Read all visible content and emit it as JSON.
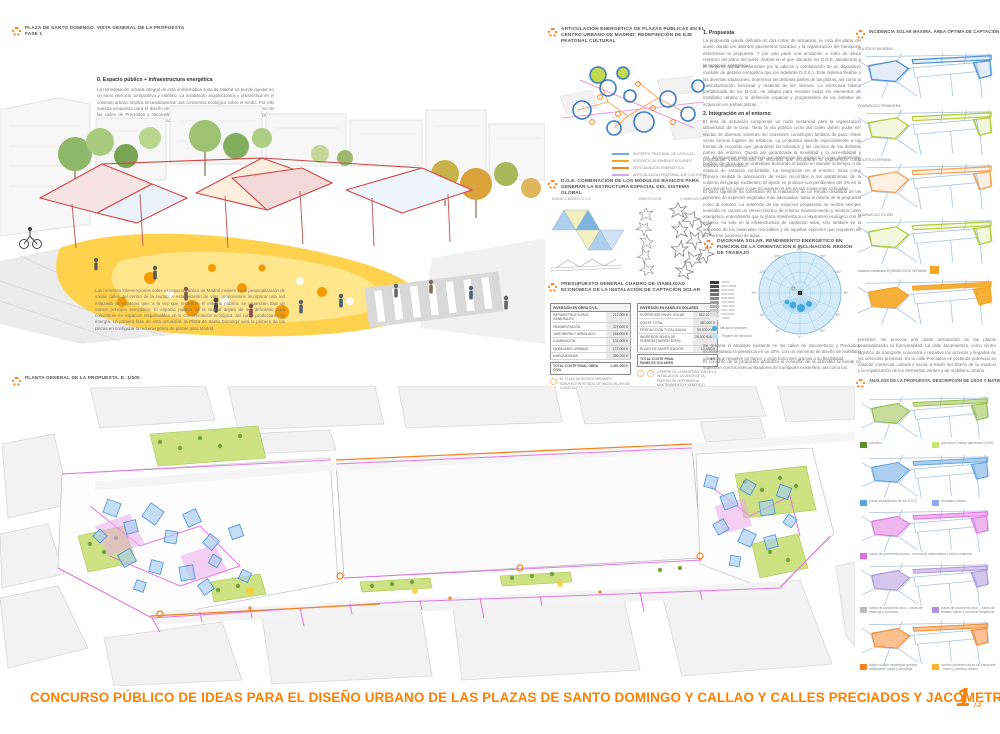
{
  "accent": "#f58220",
  "title_orange": "#ff8000",
  "top_left": {
    "title_line1": "PLAZA DE SANTO DOMINGO. VISTA GENERAL DE LA PROPUESTA",
    "title_line2": "FASE 1",
    "heading": "0. Espacio público + Infraestructura energética",
    "para1": "La remodelación urbana integral de esta emblemática zona de Madrid no puede quedar en un mero ejercicio compositivo y estético. La instalación arquitectónica y urbanística en el contexto urbano implica necesariamente una conciencia ecológica sobre el medio. Por ello nuestra propuesta para el diseño de las Plazas de Santo Domingo y Callao así como de las calles de Preciados y Jacometrezo plantea la definición de un sistema energético articulado de captación de energía solar.",
    "para2": "Las recientes intervenciones sobre el espacio público de Madrid insisten en la peatonalización de varias calles del centro de la ciudad. A esta relación de vías, proponemos incorporar una red enlazada de espacios que, a la vez que resuelven el entorno público, se organizan bajo un mismo principio energético. El espacio público de la ciudad dejará de ser deficitario para convertirse en espacios responsables en la concienciación ecológica, así como productores de energía. La primera fase de esta actuación, la Plaza de Santo Domingo será la primera de las plazas en configurar la red energética de plazas para Madrid."
  },
  "articulacion": {
    "title": "ARTICULACIÓN ENERGÉTICA DE PLAZAS PÚBLICAS EN EL CENTRO URBANO DE MADRID: REDEFINICIÓN DE EJE PEATONAL CULTURAL",
    "legend": [
      {
        "label": "SOPORTE PEATONAL DE LA PLAZA",
        "color": "#7ba7d7"
      },
      {
        "label": "SOPORTE DE PANELES SOLARES",
        "color": "#f6a623"
      },
      {
        "label": "ARTICULACIÓN ENERGÉTICA",
        "color": "#f58220"
      },
      {
        "label": "ARTICULACIÓN PEATONAL-EJE CULTURAL",
        "color": "#cfa6e8"
      }
    ]
  },
  "dge": {
    "title": "D.G.E. COMBINACIÓN DE LOS MÓDULOS BÁSICOS PARA GENERAR LA ESTRUCTURA ESPACIAL DEL SISTEMA GLOBAL",
    "col1": "MÓDULO BÁSICO D.G.E",
    "col2": "ORIENTACIÓN",
    "col3": "COMBINACIÓN"
  },
  "presupuesto": {
    "title": "PRESUPUESTO GENERAL CUADRO DE VIABILIDAD ECONÓMICA DE LA INSTALACIÓN DE CAPTACIÓN SOLAR",
    "obra": {
      "header": "INVERSIÓN EN OBRA CIVIL",
      "rows": [
        [
          "INFRAESTRUCTURAS GENERALES",
          "212.000 €"
        ],
        [
          "PAVIMENTACIÓN",
          "327.000 €"
        ],
        [
          "JARDINERÍA Y ARBOLADO",
          "264.000 €"
        ],
        [
          "ILUMINACIÓN",
          "134.000 €"
        ],
        [
          "MOBILIARIO URBANO",
          "172.000 €"
        ],
        [
          "MARQUESINAS",
          "350.000 €"
        ]
      ],
      "total_label": "TOTAL COSTE FINAL OBRA CIVIL",
      "total_value": "1.497.000 €",
      "note": "EL PLAZO SE REDUCE MEDIANTE SUBVENCIÓN ESTATAL DE HASTA UN 20% DE LA INSTALACIÓN"
    },
    "paneles": {
      "header": "INVERSIÓN EN PANELES SOLARES",
      "rows": [
        [
          "SUPERFICIE PANEL SOLAR",
          "562.10 m2"
        ],
        [
          "COSTE TOTAL",
          "380.000 €"
        ],
        [
          "PRODUCCIÓN TOTAL ANUAL",
          "55.000 Kwh"
        ],
        [
          "INGRESOS VENTA DE ENERGÍA (TARIFA+575%)",
          "26.000 €/AÑO"
        ],
        [
          "PLAZO DE AMORTIZACIÓN",
          "10 AÑOS"
        ]
      ],
      "total_label": "TOTAL COSTE FINAL PANELES SOLARES",
      "total_value": "0 €",
      "note": "A PARTIR DE LA AMORTIZACIÓN DE LA INSTALACIÓN, LA VENTA DE LA ENERGÍA SE DESTINARÁ AL MANTENIMIENTO Y BENEFICIO PÚBLICO"
    }
  },
  "propuesta": {
    "h1": "1. Propuesta",
    "p1": "La propuesta queda definida en dos cotas de actuación: la cota del plano del suelo, donde los distintos pavimentos trazados y la organización del transporte determinan la propuesta. Y por otra parte una actuación a 3,5m de altura respecto del plano del suelo, ámbito en el que ubicarán los D.G.E. atendiendo a la captación energética.",
    "p2": "El conjunto queda conformado por la adición y combinación de un dispositivo modular de gestión energética tipo (en adelante D.G.E.). Este sistema flexible a las diversas situaciones, determina las distintas partes de las plazas, así como la particularización funcional y material de los mismos. La estructura básica prefabricada de los D.G.E. se adapta para resolver todos los elementos de mobiliario urbano y la definición espacial y programática de los ámbitos de actuación en ambas plazas.",
    "h2": "2. Integración en el entorno",
    "p3": "El área de actuación comprende un nodo sustancial para la organización urbanística de la zona. Tanto la vía pública como las calles deben poder ser vividas de diversas maneras. En ocasiones constituyen ámbitos de paso. Otras veces forman lugares de estancia. La propuesta atiende especialmente a las formas de recorrido que garantizan los tránsitos y las uniones de las distintas partes del entorno. Queda así garantizada la movilidad y la accesibilidad y propiciadas varias formas de recorrido que incorporan la experiencia como objetivo arquitectónico.",
    "p4": "Así, distinguimos entre caminos que atraviesan los espacios lo más rápidamente posible, de otros que se entretejen buscando el paseo en atender al tiempo, o de espacio de estancia confortable. La integración en el entorno, toma como primera medida la adecuación de estos recorridos a las plataformas de la cubierta del garaje existentes. El ajuste se produce con pendientes del 4% en la mayoría de los casos y que no superen el 6% en las zonas más inclinadas.",
    "p5": "El paso siguiente ha consistido en la realización de un estudio detallado de las opciones de especies vegetales más adecuadas, tanto al diseño de la propuesta como al entorno. La selección de las especies propuestas se realiza siempre teniendo en cuenta un criterio técnico de mínimo mantenimiento y mínimo coste energético, entendiendo que la plaza manifiesta su compromiso ecológico con el entorno, no sólo en la infraestructura de captación solar, sino también en la selección de los materiales reciclables y de aquellas especies que requieren de un mínimo consumo de agua."
  },
  "solar": {
    "title": "DIAGRAMA SOLAR. RENDIMIENTO ENERGÉTICO EN FUNCIÓN DE LA ORIENTACIÓN E INCLINACIÓN. REGIÓN DE TRABAJO",
    "scale": [
      {
        "label": "100%",
        "color": "#3a3a3a"
      },
      {
        "label": "95%-100%",
        "color": "#4d4d4d"
      },
      {
        "label": "90%-95%",
        "color": "#606060"
      },
      {
        "label": "85%-90%",
        "color": "#737373"
      },
      {
        "label": "80%-85%",
        "color": "#8a8a8a"
      },
      {
        "label": "75%-80%",
        "color": "#9e9e9e"
      },
      {
        "label": "70%-75%",
        "color": "#b3b3b3"
      },
      {
        "label": "65%-70%",
        "color": "#c7c7c7"
      },
      {
        "label": "60%-65%",
        "color": "#dcdcdc"
      },
      {
        "label": "<50%",
        "color": "#efefef"
      }
    ],
    "degrees": [
      "180°",
      "150°",
      "120°",
      "90°",
      "60°",
      "30°",
      "0°",
      "-30°",
      "-60°",
      "-90°",
      "-120°",
      "-150°"
    ],
    "legend_dot": "situación paneles",
    "legend_region": "Región de afección",
    "p1": "Se respeta el arbolado existente en las calles de Jacometrezo y Preciados, incrementando la presencia en un 20%, con un elemento de diseño de mobiliario urbano que resuelve un banco y otras funciones gracias a su flexibilidad.",
    "p2": "El conjunto de la propuesta garantiza la conexión de la actividad funcional en superficie con los intercambiadores de transporte existentes, así como los"
  },
  "incidencia": {
    "title": "INCIDENCIA SOLAR MÁXIMA. ÁREA ÓPTIMA DE CAPTACIÓN",
    "maps": [
      {
        "label": "SOLSTICIO INVIERNO",
        "color": "#4a90d9"
      },
      {
        "label": "EQUINOCCIO PRIMAVERA",
        "color": "#b5cc34"
      },
      {
        "label": "SOLSTICIO VERANO",
        "color": "#f5a04c"
      },
      {
        "label": "EQUINOCCIO OTOÑO",
        "color": "#b5cc34"
      },
      {
        "label": "máxima incidencia EQUINOCCIOS  VERANO",
        "color": "#f5a623"
      }
    ],
    "p": "previstos. Se provoca una doble articulación de las plazas peatonalizando su funcionalidad. La calle Jacometrezo, como centro logístico de transporte concentra y resuelve los accesos y llegadas de los vehículos previstos. En la calle Preciados se pretende potenciar su carácter comercial, cultural y social, a través del diseño de su espacio y la organización de los elementos verdes y de mobiliario urbano."
  },
  "planta": {
    "title": "PLANTA GENERAL DE LA PROPUESTA. e: 1/500"
  },
  "analisis": {
    "title": "ANÁLISIS DE LA PROPUESTA. DESCRIPCIÓN DE USOS Y MATERIALES",
    "maps": [
      {
        "highlight": "#8fbc3a",
        "legends": [
          {
            "color": "#5b9226",
            "label": "arbolado"
          },
          {
            "color": "#c6e377",
            "label": "pavimento blando ajardinado (30%)"
          }
        ]
      },
      {
        "highlight": "#5aa0e0",
        "legends": [
          {
            "color": "#5aa7e0",
            "label": "zonas implantación de los D.G.E."
          },
          {
            "color": "#8fa8f0",
            "label": "mobiliario urbano"
          }
        ]
      },
      {
        "highlight": "#e06ce0",
        "legends": [
          {
            "color": "#e06ce0",
            "label": "zonas de pavimento sonoro - recorridos relacionales y ritmo comercial"
          }
        ]
      },
      {
        "highlight": "#a98fd8",
        "legends": [
          {
            "color": "#bbbbbb",
            "label": "zonas de pavimento duro - zonas de estancia y comercio"
          },
          {
            "color": "#b08fe0",
            "label": "zonas de pavimento duro - zonas de tránsito rápido y recorrido tangencial"
          }
        ]
      },
      {
        "highlight": "#f58220",
        "legends": [
          {
            "color": "#f58220",
            "label": "tráfico rodado restringido garajes particulares carga y descarga"
          },
          {
            "color": "#f9b233",
            "label": "acceso infraestructuras de transporte - metro y autobús urbano"
          }
        ]
      }
    ]
  },
  "footer": {
    "title": "CONCURSO PÚBLICO DE IDEAS PARA EL DISEÑO URBANO DE LAS PLAZAS DE SANTO DOMINGO Y CALLAO Y CALLES PRECIADOS Y JACOMETREZO",
    "page_big": "1",
    "page_small": "/3"
  }
}
